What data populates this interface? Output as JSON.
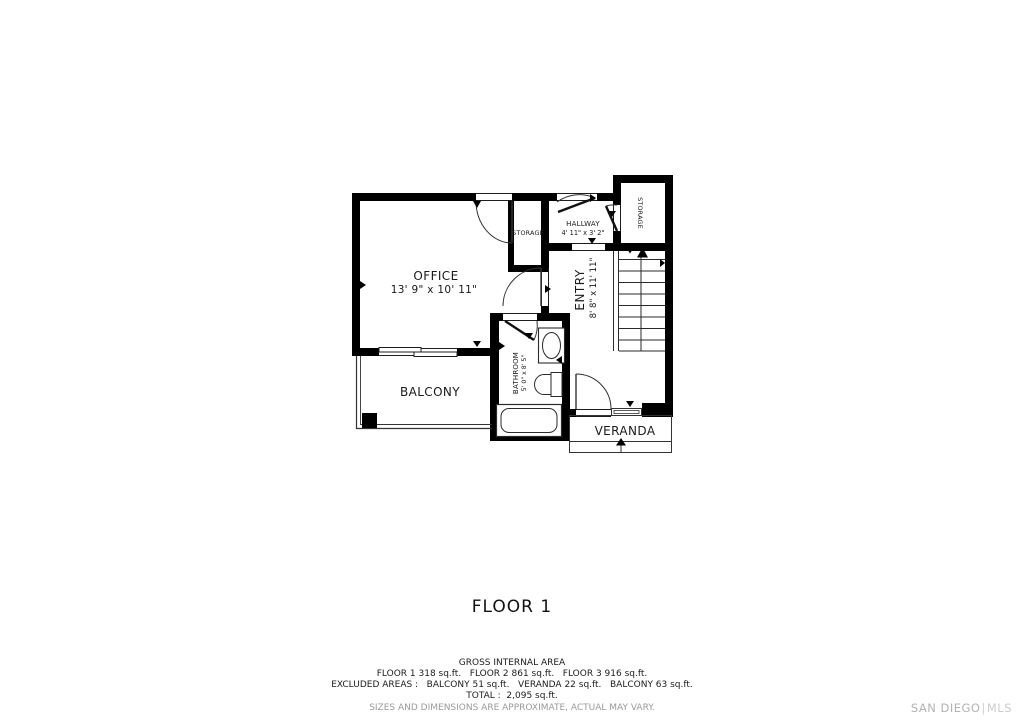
{
  "title": "FLOOR 1",
  "plan": {
    "office": {
      "label": "OFFICE",
      "dims": "13' 9\" x 10' 11\""
    },
    "balcony": {
      "label": "BALCONY"
    },
    "bathroom": {
      "label": "BATHROOM",
      "dims": "5' 0\" x 8' 5\""
    },
    "entry": {
      "label": "ENTRY",
      "dims": "8' 8\" x 11' 11\""
    },
    "hallway": {
      "label": "HALLWAY",
      "dims": "4' 11\" x 3' 2\""
    },
    "storage_closet": {
      "label": "STORAGE"
    },
    "storage_right": {
      "label": "STORAGE"
    },
    "veranda": {
      "label": "VERANDA"
    }
  },
  "footer": {
    "line1": "GROSS INTERNAL AREA",
    "line2": "FLOOR 1 318 sq.ft.   FLOOR 2 861 sq.ft.   FLOOR 3 916 sq.ft.",
    "line3": "EXCLUDED AREAS :   BALCONY 51 sq.ft.   VERANDA 22 sq.ft.   BALCONY 63 sq.ft.",
    "line4": "TOTAL :  2,095 sq.ft.",
    "disclaimer": "SIZES AND DIMENSIONS ARE APPROXIMATE, ACTUAL MAY VARY."
  },
  "watermark": {
    "brand": "SAN DIEGO",
    "divider": "|",
    "suffix": "MLS"
  },
  "colors": {
    "wall": "#000000",
    "text": "#1a1a1a",
    "thin_line": "#2a2a2a",
    "muted": "#9a9a9a",
    "watermark": "#c4c4c4",
    "background": "#ffffff"
  }
}
